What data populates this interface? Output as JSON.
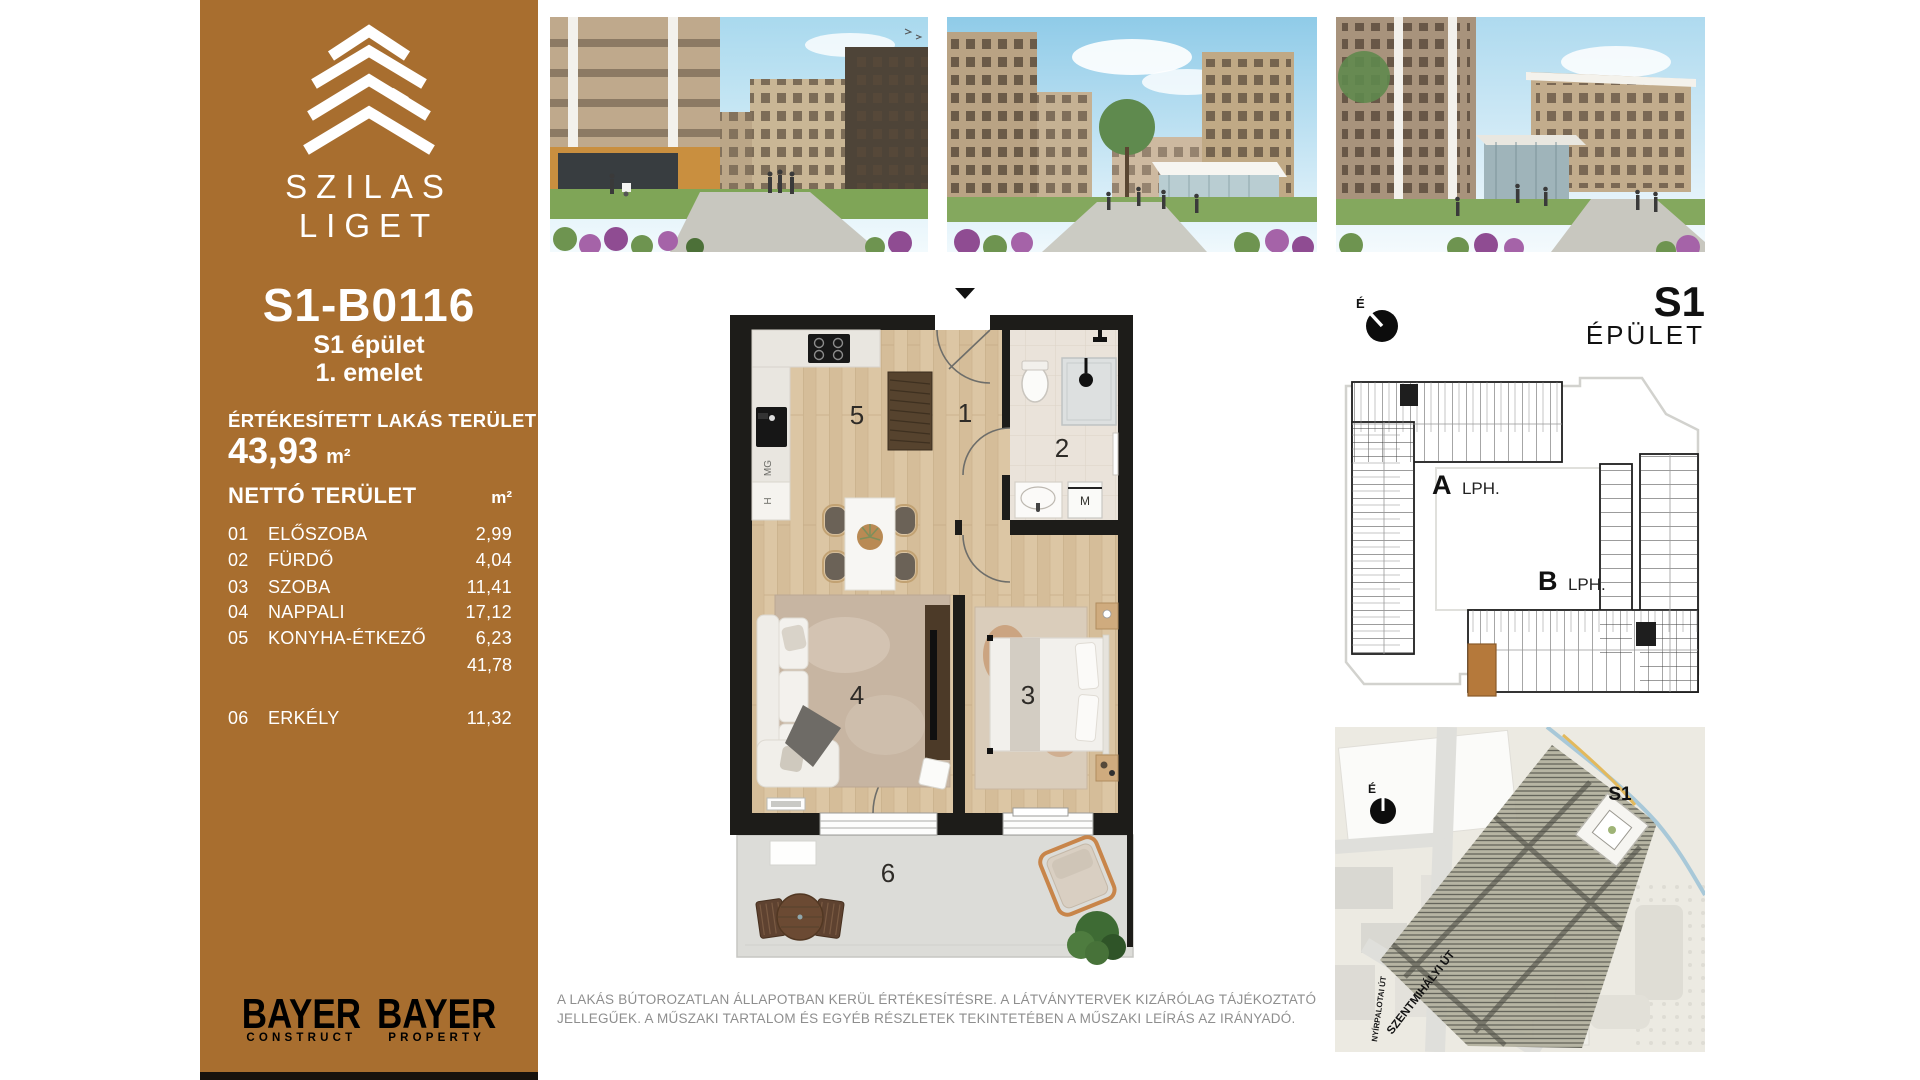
{
  "sidebar": {
    "bg_color": "#A86E2F",
    "brand_line1": "SZILAS",
    "brand_line2": "LIGET",
    "unit_code": "S1-B0116",
    "building_line": "S1 épület",
    "floor_line": "1. emelet",
    "sold_area": {
      "label": "ÉRTÉKESÍTETT LAKÁS TERÜLET",
      "value": "43,93",
      "unit": "m²"
    },
    "net_area": {
      "label": "NETTÓ TERÜLET",
      "unit": "m²"
    },
    "rooms": [
      {
        "num": "01",
        "name": "ELŐSZOBA",
        "area": "2,99"
      },
      {
        "num": "02",
        "name": "FÜRDŐ",
        "area": "4,04"
      },
      {
        "num": "03",
        "name": "SZOBA",
        "area": "11,41"
      },
      {
        "num": "04",
        "name": "NAPPALI",
        "area": "17,12"
      },
      {
        "num": "05",
        "name": "KONYHA-ÉTKEZŐ",
        "area": "6,23"
      }
    ],
    "net_total": "41,78",
    "balcony_row": {
      "num": "06",
      "name": "ERKÉLY",
      "area": "11,32"
    },
    "logos": {
      "left": {
        "name": "BAYER",
        "division": "CONSTRUCT"
      },
      "right": {
        "name": "BAYER",
        "division": "PROPERTY"
      }
    }
  },
  "floor_plan": {
    "room_numbers": {
      "hall": "1",
      "bath": "2",
      "bedroom": "3",
      "living": "4",
      "kitchen": "5",
      "balcony": "6"
    },
    "appliances": {
      "dishwasher": "MG",
      "fridge": "H",
      "washer": "M"
    }
  },
  "building_plan": {
    "compass": "É",
    "title": "S1",
    "subtitle": "ÉPÜLET",
    "stair_a_bold": "A",
    "stair_a_text": "LPH.",
    "stair_b_bold": "B",
    "stair_b_text": "LPH.",
    "highlight_color": "#B5793B"
  },
  "site_map": {
    "compass": "É",
    "building_label": "S1",
    "street_1": "NYÍRPALOTAI ÚT",
    "street_2": "SZENTMIHÁLYI ÚT"
  },
  "disclaimer": {
    "line1": "A LAKÁS BÚTOROZATLAN ÁLLAPOTBAN KERÜL ÉRTÉKESÍTÉSRE. A LÁTVÁNYTERVEK KIZÁRÓLAG TÁJÉKOZTATÓ",
    "line2": "JELLEGŰEK. A MŰSZAKI TARTALOM ÉS EGYÉB RÉSZLETEK TEKINTETÉBEN A MŰSZAKI LEÍRÁS AZ IRÁNYADÓ."
  }
}
